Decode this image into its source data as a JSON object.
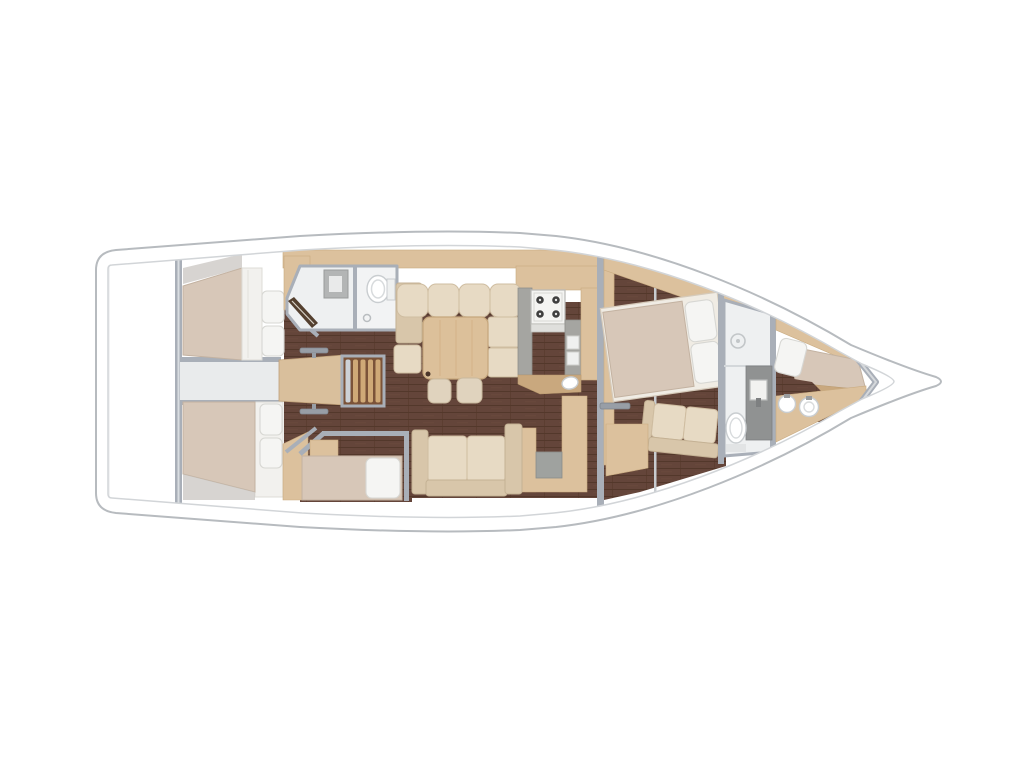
{
  "figure": {
    "kind": "sailing-yacht-interior-floor-plan",
    "orientation": "bow-right-stern-left",
    "background": "#ffffff",
    "text_labels": []
  },
  "colors": {
    "hull-outline": "#b7bbbf",
    "deck-line": "#d2d5d8",
    "wall": "#a9afb8",
    "wall-light": "#cdd1d6",
    "wood-tan": "#dcc19d",
    "wood-tan-dark": "#c9a87e",
    "wood-platform": "#d9bf9c",
    "stair-slat": "#cfa977",
    "stair-well": "#7b5339",
    "mattress": "#d7c7b8",
    "pillow": "#f5f5f3",
    "sofa": "#e7dac4",
    "sofa-shadow": "#d8c6aa",
    "table": "#dcc09a",
    "counter": "#a5a5a1",
    "appliance": "#f4f4f2",
    "burner": "#3f3f3f",
    "bath-floor": "#eef0f1",
    "fixture": "#8f9192",
    "bath-corridor": "#e9ebec",
    "floor-plank": "#64453a",
    "floor-plank-line": "#4f3527"
  },
  "rooms": [
    {
      "name": "stern-lazarette",
      "fixtures": []
    },
    {
      "name": "aft-cabin-port",
      "fixtures": [
        "double-berth",
        "two-pillows",
        "wardrobe"
      ]
    },
    {
      "name": "aft-cabin-starboard",
      "fixtures": [
        "double-berth",
        "two-pillows",
        "wardrobe"
      ]
    },
    {
      "name": "aft-head",
      "fixtures": [
        "shower",
        "toilet",
        "floor-drain",
        "open-door"
      ]
    },
    {
      "name": "companionway",
      "fixtures": [
        "engine-box-platform",
        "five-step-ladder",
        "cabin-door-handles"
      ]
    },
    {
      "name": "saloon",
      "fixtures": [
        "u-shaped-settee",
        "dining-table",
        "two-stools",
        "straight-settee"
      ]
    },
    {
      "name": "galley",
      "fixtures": [
        "four-burner-stove",
        "twin-sink-covers",
        "round-sink",
        "worktops",
        "tall-locker"
      ]
    },
    {
      "name": "navigation-station",
      "fixtures": [
        "chart-table",
        "nav-seat"
      ]
    },
    {
      "name": "bunk-cabin",
      "fixtures": [
        "single-berth",
        "pillow",
        "locker"
      ]
    },
    {
      "name": "forward-cabin",
      "fixtures": [
        "island-double-berth",
        "two-pillows",
        "sofa",
        "seat-bench",
        "door-handle"
      ]
    },
    {
      "name": "forward-head",
      "fixtures": [
        "shower",
        "floor-drain",
        "vanity-sink",
        "toilet"
      ]
    },
    {
      "name": "forepeak-crew-cabin",
      "fixtures": [
        "single-berth",
        "pillow",
        "counter",
        "twin-round-basins",
        "collision-bulkhead"
      ]
    }
  ]
}
